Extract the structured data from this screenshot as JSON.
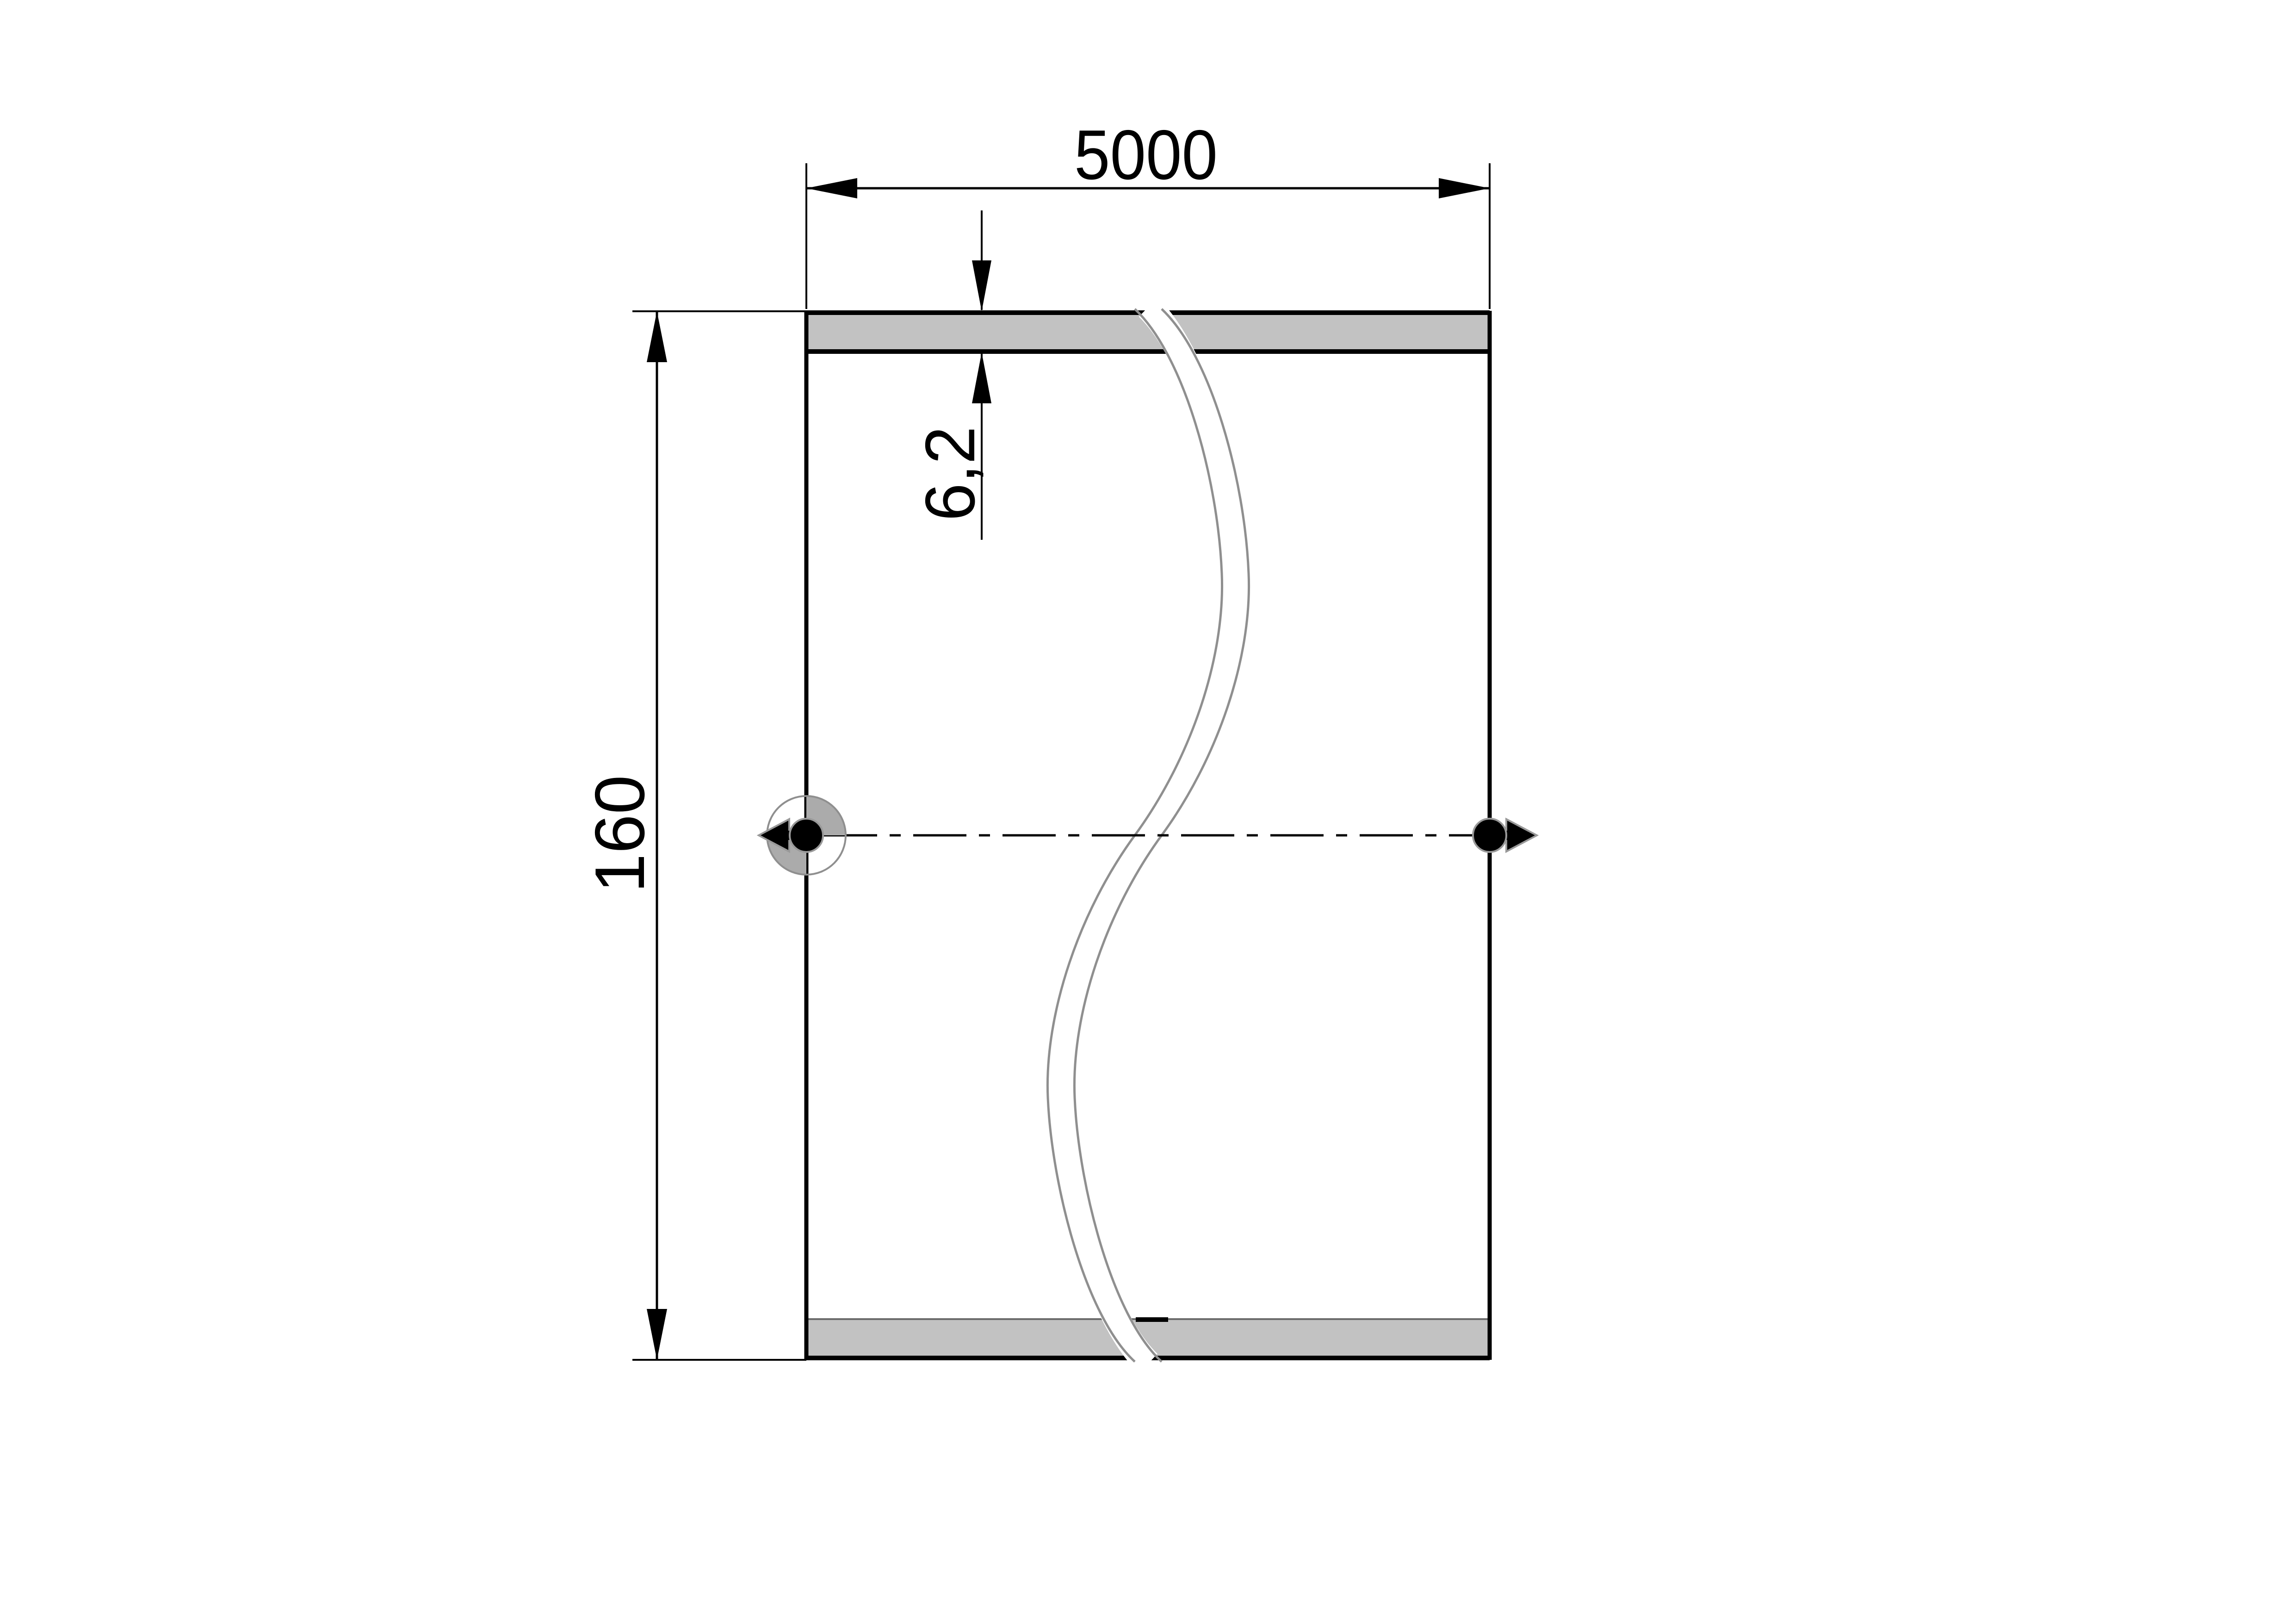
{
  "drawing": {
    "type": "technical-dimension-drawing",
    "dimensions": {
      "width": {
        "label": "5000"
      },
      "height": {
        "label": "160"
      },
      "thickness": {
        "label": "6,2"
      }
    },
    "colors": {
      "line": "#000000",
      "band_fill": "#c2c2c2",
      "break_edge": "#8f8f8f",
      "marker_gray": "#ababab",
      "background": "#ffffff"
    }
  }
}
